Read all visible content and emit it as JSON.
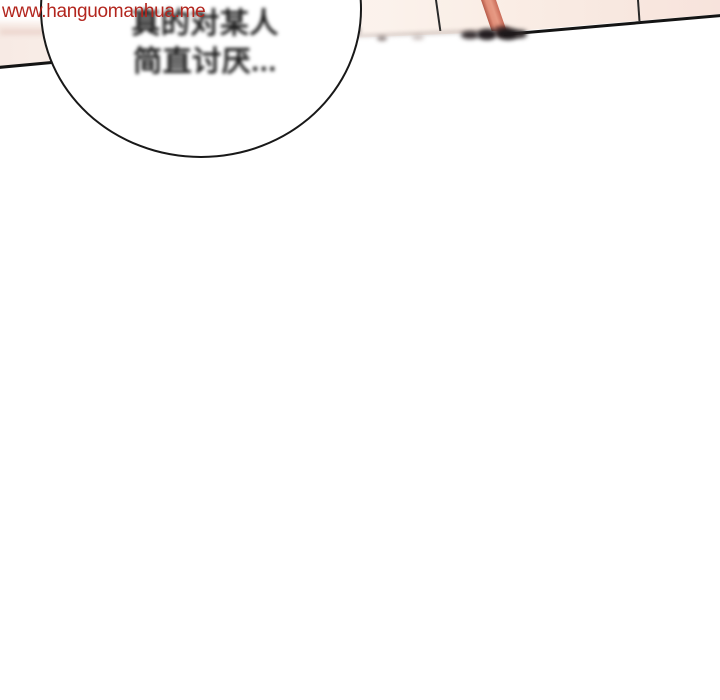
{
  "watermark": {
    "text": "www.hanguomanhua.me",
    "color": "#b3261e"
  },
  "speech_bubble": {
    "line1": "真的对某人",
    "line2": "简直讨厌...",
    "fill": "#ffffff",
    "outline_color": "#191919",
    "text_color": "#1b1b1b"
  },
  "panel_fragment": {
    "skin_pink": "#fbf2ec",
    "right_pink": "#f7e3dc",
    "stripe_color": "#e2907a",
    "edge_color": "#141414"
  },
  "page": {
    "background": "#ffffff"
  }
}
